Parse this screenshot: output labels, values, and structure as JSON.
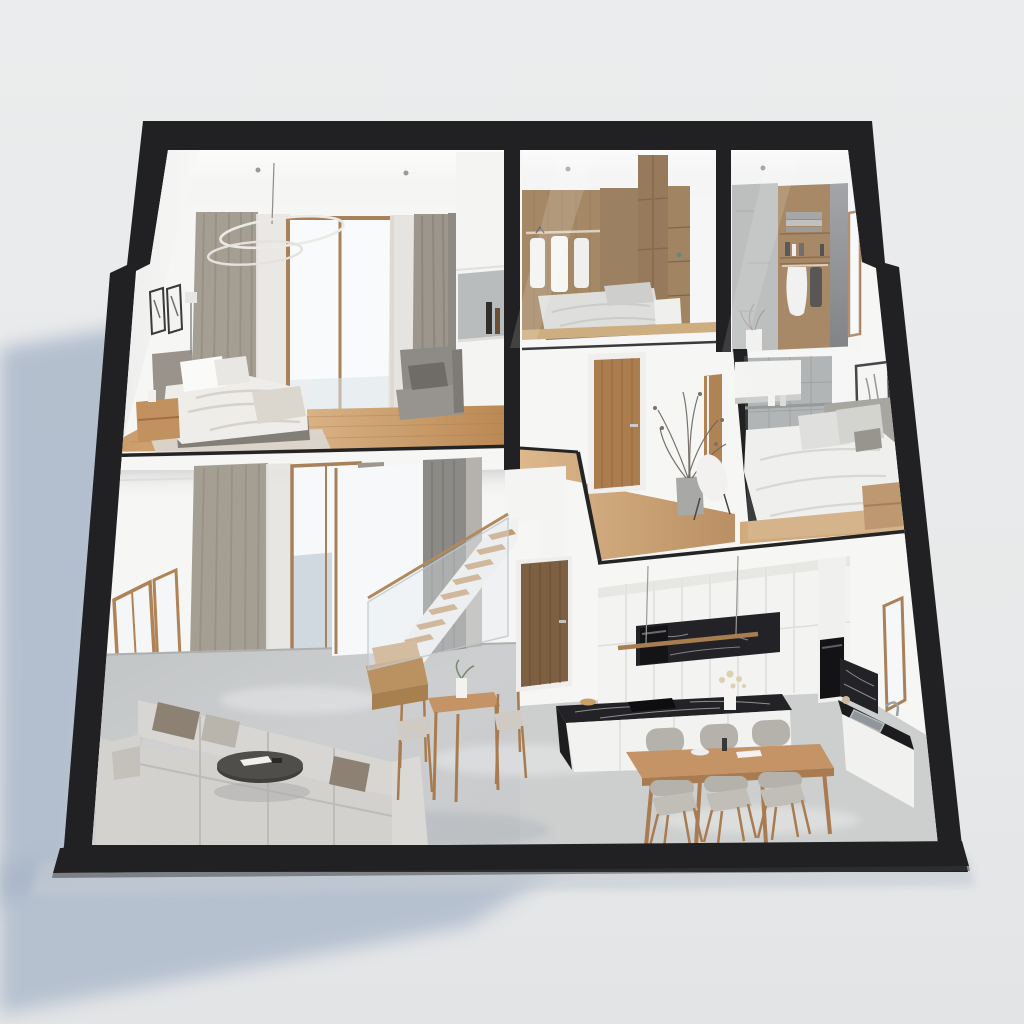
{
  "scene": {
    "title": "3D dollhouse cutaway render of a two-storey minimalist apartment",
    "style": "photorealistic architectural section visualization, isometric-like view",
    "shell": "thick black sectioned wall frame, trapezoid silhouette leaning right",
    "floors": [
      "upper floor: master bedroom, walk-in closet bedroom, bathroom, hallway, second bedroom",
      "ground floor: double-height living room, staircase, kitchen, dining area"
    ]
  },
  "background": {
    "color": "#e9eaec",
    "color_bottom": "#e3e5e7",
    "shadow_color": "#a7b5c8"
  },
  "palette": {
    "frame": "#212123",
    "wall": "#f6f6f5",
    "wall_bright": "#fcfcfb",
    "ceiling_shade": "#e7e8e7",
    "wood_frame": "#a8805a",
    "wood_wall": "#9a7850",
    "wood_dark": "#7d5f41",
    "wood_floor_light": "#d9b285",
    "wood_floor_dark": "#b8854f",
    "wood_furniture": "#c49467",
    "door_walnut": "#7d5f41",
    "door_oak": "#ab7c4e",
    "curtain": "#a59e93",
    "curtain_dark": "#8b8a86",
    "sheer": "#e8e6e2",
    "window_glow": "#f8fafb",
    "window_view": "#c7d1da",
    "sofa": "#d2d1cd",
    "sofa_light": "#dad9d5",
    "pillow_taupe": "#8d8174",
    "concrete": "#c6c8c9",
    "concrete_light": "#cdcfcf",
    "concrete_wall": "#b5b7b6",
    "tile_gray": "#a9acad",
    "marble": "#232327",
    "marble_vein": "#d8d8d6",
    "steel": "#9aa0a4",
    "glass_sheen": "rgba(255,255,255,0.22)"
  },
  "rooms": {
    "master_bedroom": {
      "label": "Master bedroom (upper left)",
      "furniture": [
        "double bed with greige duvet",
        "gray headboard",
        "oak nightstand",
        "ring chandelier",
        "taupe curtains",
        "glass door window",
        "gray armchair",
        "two framed sketches",
        "wood floor"
      ]
    },
    "closet_bedroom": {
      "label": "Walk-in closet bedroom (upper middle)",
      "furniture": [
        "oak panelled wall",
        "open rail with white shirts",
        "tall oak wardrobe",
        "low bed",
        "glass front"
      ]
    },
    "bathroom": {
      "label": "Bathroom closet (upper right)",
      "furniture": [
        "concrete wall",
        "oak shelf with towels and bottles",
        "hanging white robe",
        "glass screen",
        "dried plant"
      ]
    },
    "hallway": {
      "label": "Upper hallway",
      "furniture": [
        "oak door with white architrave",
        "second door frame",
        "dried branch plant in vase",
        "chair with white throw",
        "wood floor"
      ]
    },
    "second_bedroom": {
      "label": "Second bedroom (right)",
      "furniture": [
        "gray tile wall",
        "white wall cabinet",
        "bed with white duvet",
        "oak nightstand",
        "framed art",
        "glass front"
      ]
    },
    "living_room": {
      "label": "Double-height living room",
      "furniture": [
        "U-shaped light gray sectional sofa",
        "taupe cushions",
        "round dark coffee table",
        "tall oak side table with chairs",
        "floor-to-ceiling curtains",
        "wood framed glazing",
        "polished concrete floor"
      ]
    },
    "staircase": {
      "label": "Staircase",
      "furniture": [
        "oak winder base steps",
        "white stringer flight with oak treads",
        "glass balustrade with oak handrail",
        "dark curtain backdrop",
        "walnut door below landing"
      ]
    },
    "kitchen": {
      "label": "Kitchen",
      "furniture": [
        "white slab cabinets",
        "black marble splashback niche with oven",
        "linear oak pendant light",
        "black marble island with hob and flowers",
        "tall unit with built-in oven",
        "black marble counter with sink",
        "wood framed mirror"
      ]
    },
    "dining": {
      "label": "Dining area",
      "furniture": [
        "long oak dining table",
        "six gray upholstered chairs with oak legs",
        "bowl and pepper mill"
      ]
    }
  }
}
